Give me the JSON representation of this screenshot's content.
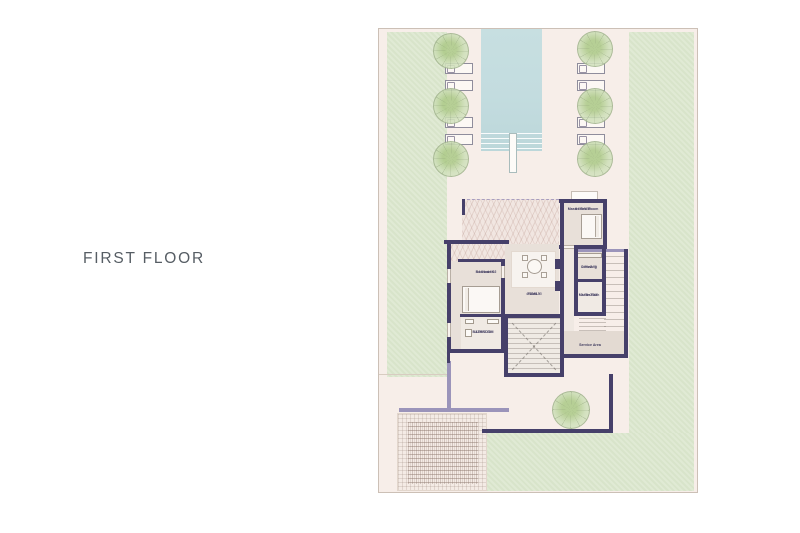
{
  "page": {
    "title": "FIRST FLOOR"
  },
  "plan": {
    "rooms": {
      "master_bedroom": {
        "name": "Master Bed Room",
        "dims": "4.50x5.50"
      },
      "bedroom_02": {
        "name": "Bedroom 02",
        "dims": "4.00x4.00"
      },
      "dressing": {
        "name": "Dressing",
        "dims": "1.75x2.75"
      },
      "master_bath": {
        "name": "Master Bath",
        "dims": "1.75x2.50"
      },
      "bathroom": {
        "name": "BATHROOM",
        "dims": "1.80x2.75"
      },
      "family": {
        "name": "FAMILY",
        "dims": "4.00x4.10"
      },
      "service_area": {
        "name": "Service Area"
      }
    },
    "colors": {
      "wall": "#46406a",
      "wall_light": "#9b94ba",
      "lawn": "#dde8d0",
      "pool": "#c3dcdf",
      "paper": "#f7eee9",
      "title_text": "#565d64"
    }
  }
}
